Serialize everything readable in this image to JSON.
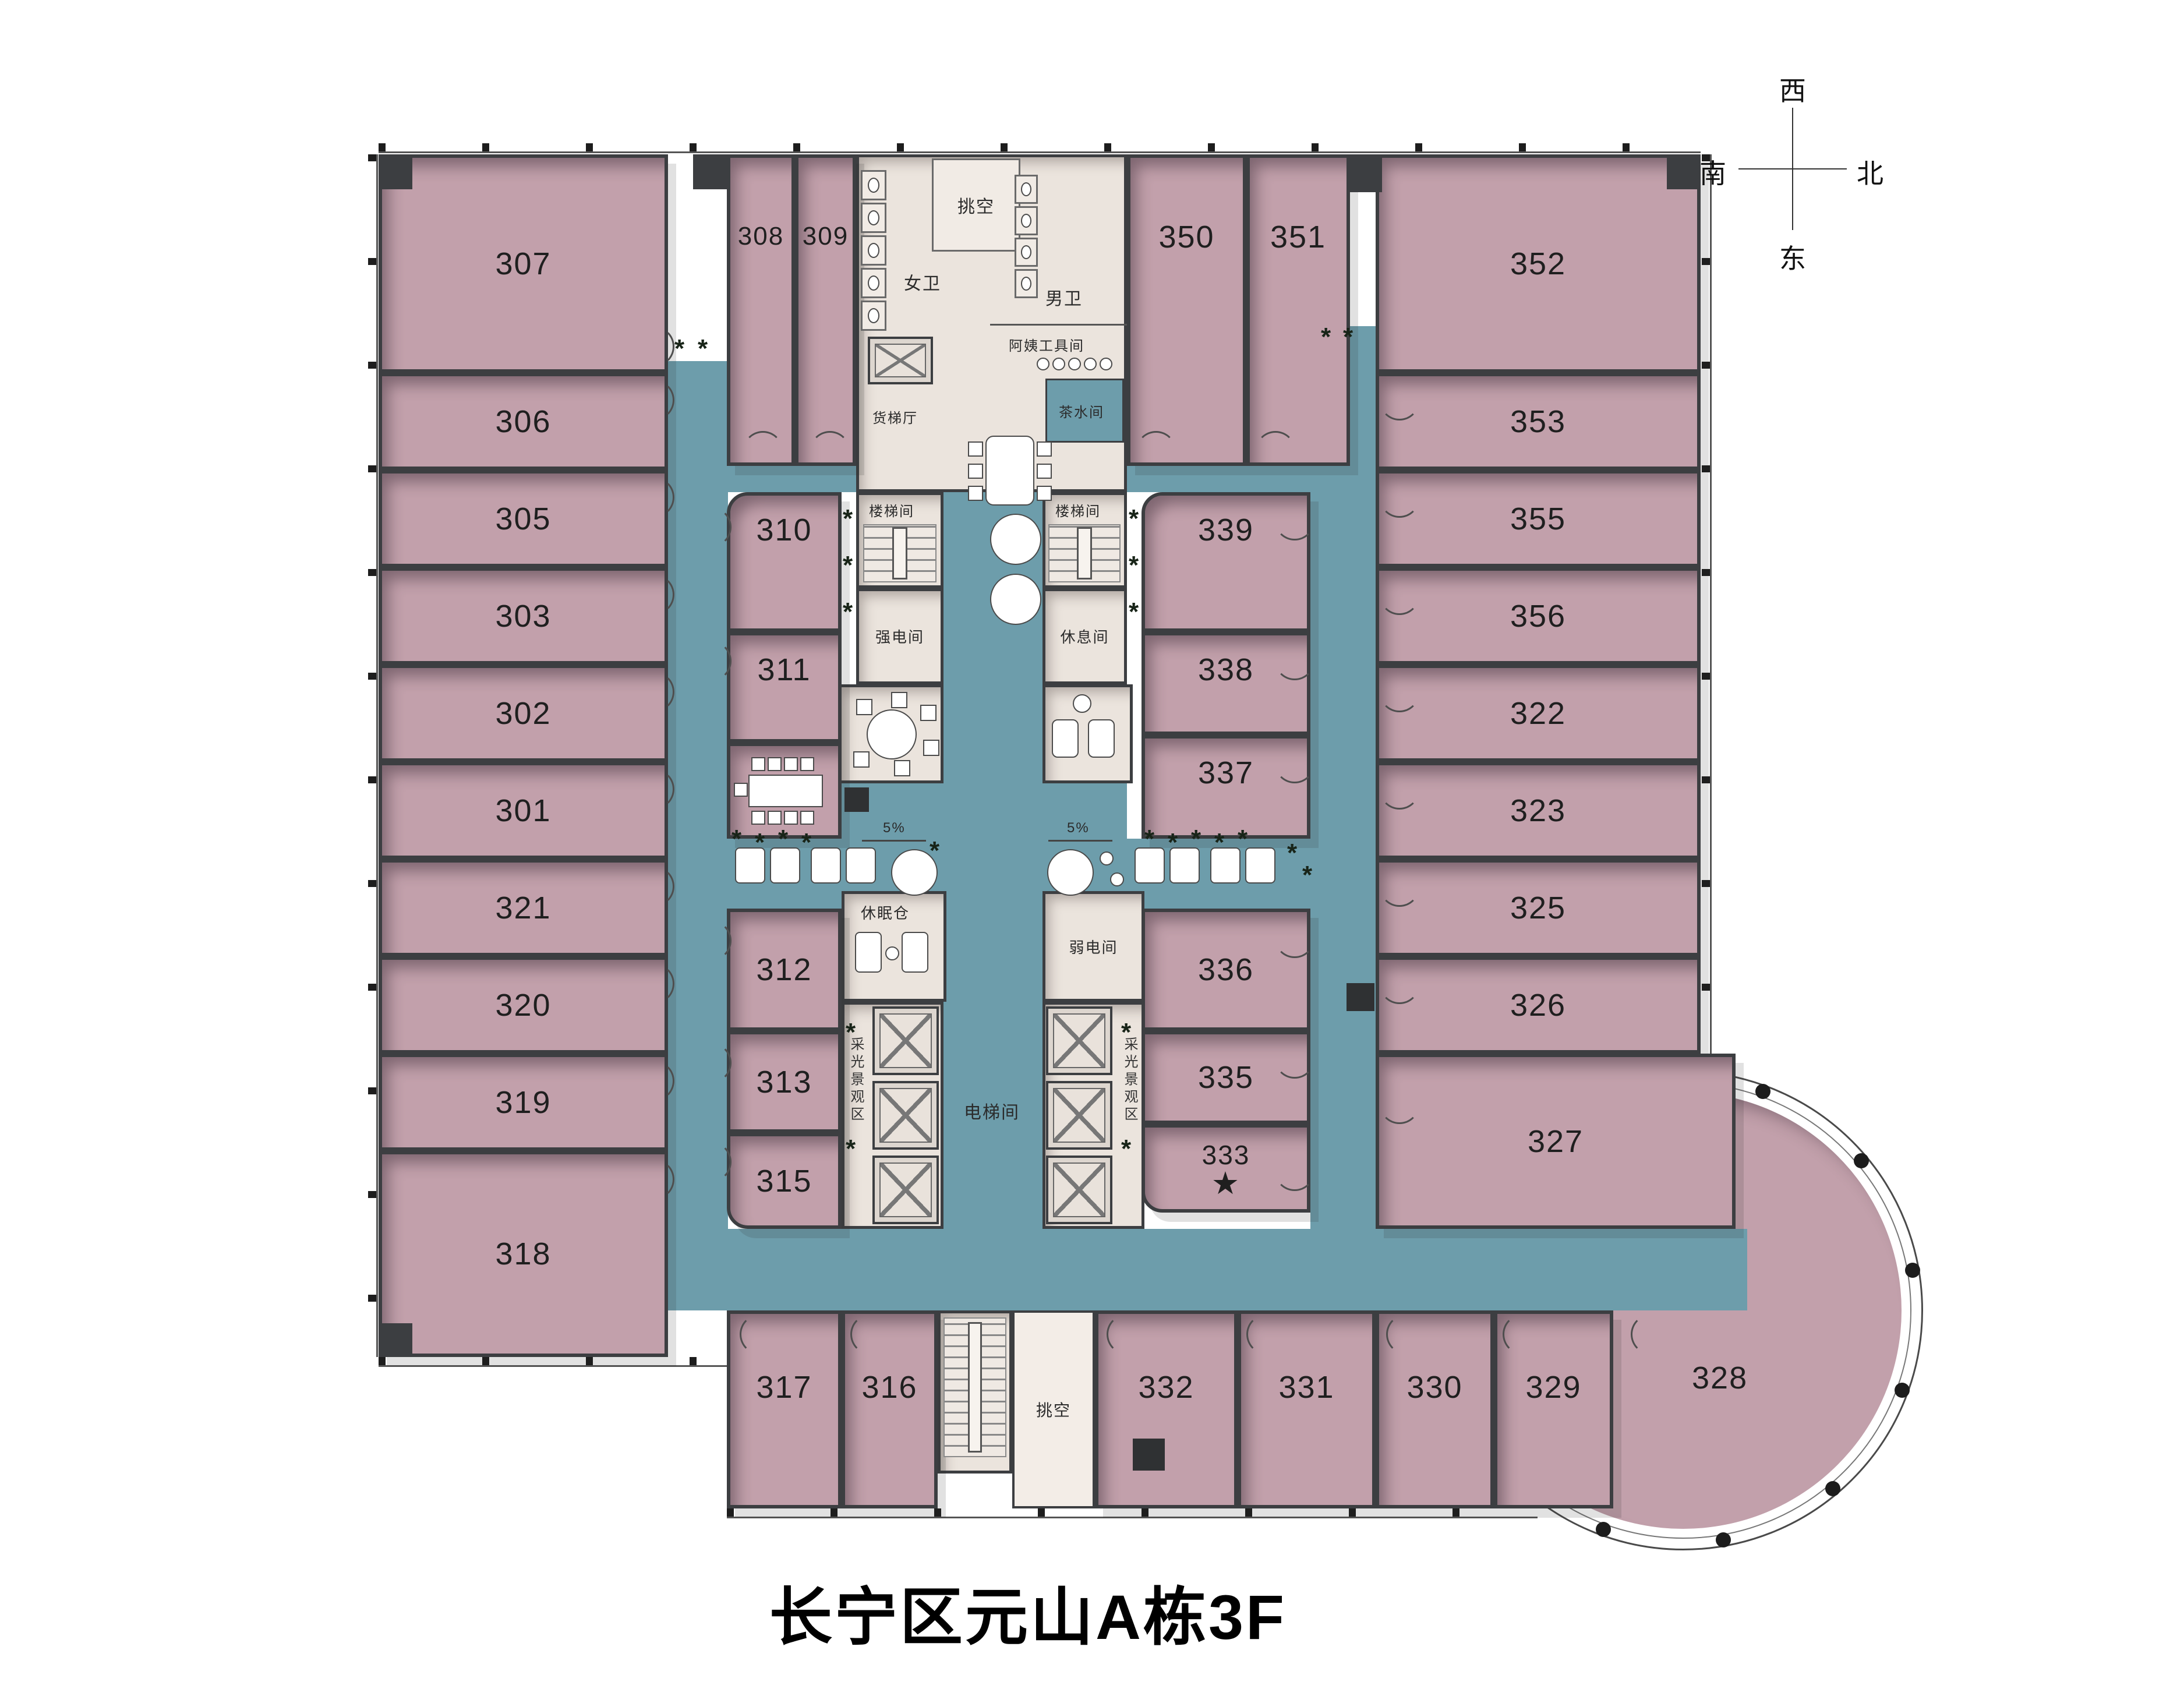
{
  "title": "长宁区元山A栋3F",
  "compass": {
    "top": "西",
    "left": "南",
    "right": "北",
    "bottom": "东"
  },
  "rooms": {
    "r301": "301",
    "r302": "302",
    "r303": "303",
    "r305": "305",
    "r306": "306",
    "r307": "307",
    "r308": "308",
    "r309": "309",
    "r310": "310",
    "r311": "311",
    "r312": "312",
    "r313": "313",
    "r315": "315",
    "r316": "316",
    "r317": "317",
    "r318": "318",
    "r319": "319",
    "r320": "320",
    "r321": "321",
    "r322": "322",
    "r323": "323",
    "r325": "325",
    "r326": "326",
    "r327": "327",
    "r328": "328",
    "r329": "329",
    "r330": "330",
    "r331": "331",
    "r332": "332",
    "r333": "333",
    "r335": "335",
    "r336": "336",
    "r337": "337",
    "r338": "338",
    "r339": "339",
    "r350": "350",
    "r351": "351",
    "r352": "352",
    "r353": "353",
    "r355": "355",
    "r356": "356"
  },
  "labels": {
    "void_top": "挑空",
    "void_bottom": "挑空",
    "womens_wc": "女卫",
    "mens_wc": "男卫",
    "cleaner_room": "阿姨工具间",
    "freight_lift_hall": "货梯厅",
    "pantry": "茶水间",
    "stair_left": "楼梯间",
    "stair_right": "楼梯间",
    "strong_power": "强电间",
    "lounge": "休息间",
    "sleep_pods": "休眠仓",
    "weak_power": "弱电间",
    "lift_lobby": "电梯间",
    "daylight_left": "采光景观区",
    "daylight_right": "采光景观区",
    "ramp_left": "5%",
    "ramp_right": "5%"
  },
  "marker": {
    "glyph": "★",
    "room": "333"
  },
  "icons": {
    "plant": "*"
  },
  "colors": {
    "room_fill": "#c2a0ab",
    "corridor": "#6d9dab",
    "core": "#ebe4dd",
    "wall": "#3c3e41",
    "star": "#f20d0d"
  }
}
